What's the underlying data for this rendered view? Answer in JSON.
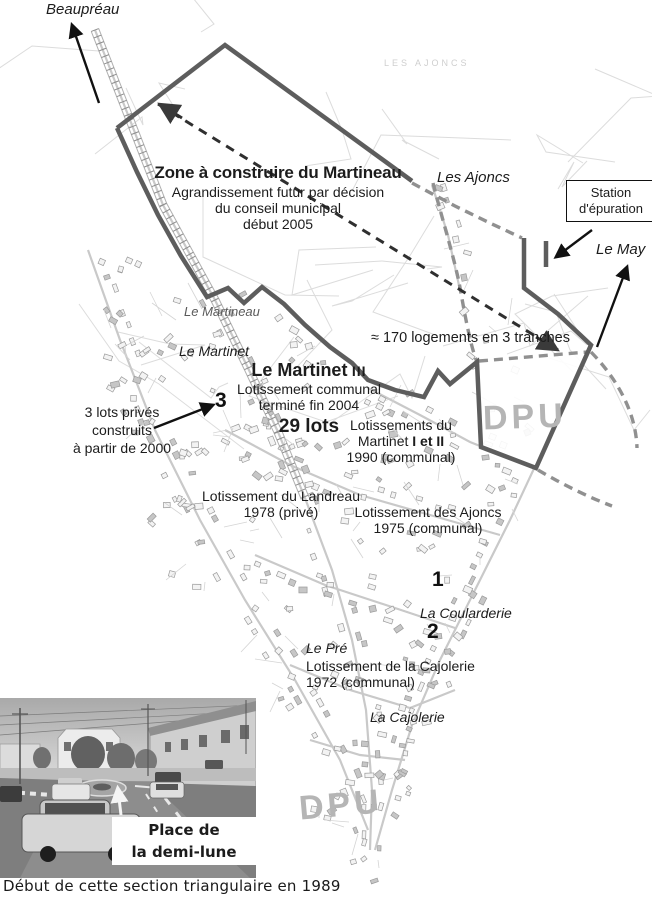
{
  "colors": {
    "boundary": "#5d5d5d",
    "dpu_dashed": "#909090",
    "black_arrow": "#111111",
    "dashed_arrow": "#2f2f2f",
    "map_texture": "#c9c9c9",
    "dpu_text": "#b5b5b5"
  },
  "map": {
    "bg_label": "LES AJONCS",
    "dpu_label_top": "DPU",
    "dpu_label_bottom": "DPU",
    "places": {
      "beaupreau": "Beaupréau",
      "les_ajoncs": "Les Ajoncs",
      "le_may": "Le May",
      "le_martineau": "Le Martineau",
      "le_martinet": "Le Martinet",
      "la_coularderie": "La Coularderie",
      "le_pre": "Le Pré",
      "la_cajolerie": "La Cajolerie"
    },
    "zone": {
      "title": "Zone à construire du Martineau",
      "line1": "Agrandissement futur par décision",
      "line2": "du conseil municipal",
      "line3": "début 2005"
    },
    "station": {
      "line1": "Station",
      "line2": "d'épuration"
    },
    "tranches": "≈ 170 logements en 3 tranches",
    "martinet3": {
      "title_main": "Le Martinet",
      "title_num": "III",
      "line1": "Lotissement communal",
      "line2": "terminé fin 2004",
      "lots": "29 lots"
    },
    "lots_prives": {
      "line1": "3 lots privés",
      "line2": "construits",
      "line3": "à partir de 2000"
    },
    "martinet12": {
      "line1": "Lotissements du",
      "line2_pre": "Martinet ",
      "line2_bold": "I et II",
      "line3": "1990 (communal)"
    },
    "landreau": {
      "line1": "Lotissement du Landreau",
      "line2": "1978 (privé)"
    },
    "ajoncs_lot": {
      "line1": "Lotissement des Ajoncs",
      "line2": "1975 (communal)"
    },
    "cajolerie_lot": {
      "line1": "Lotissement de la Cajolerie",
      "line2": "1972 (communal)"
    },
    "markers": {
      "m1": "1",
      "m2": "2",
      "m3": "3"
    }
  },
  "photo": {
    "label": {
      "line1": "Place de",
      "line2": "la demi-lune"
    },
    "caption": "Début de cette section triangulaire en 1989"
  }
}
